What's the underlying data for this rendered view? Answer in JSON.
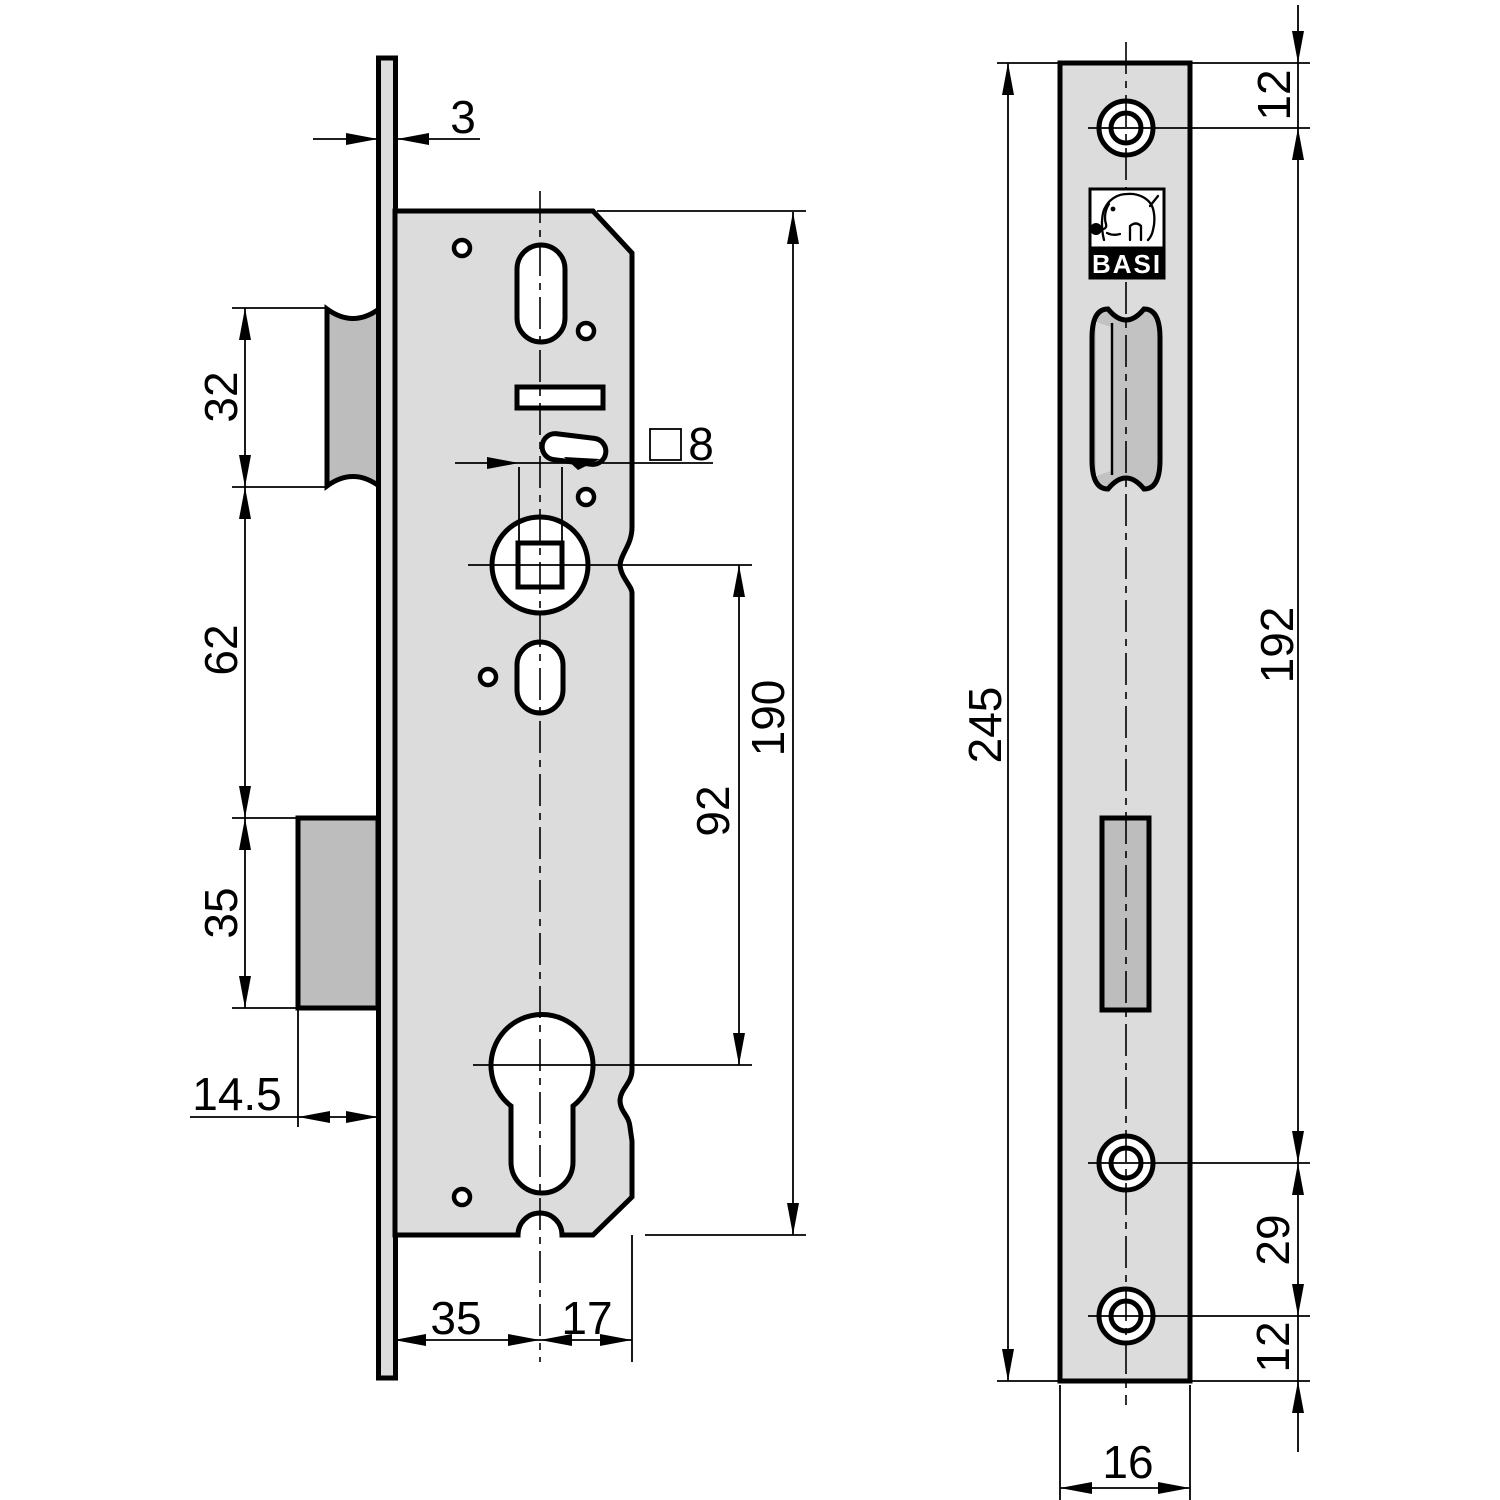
{
  "left_view": {
    "plate_thickness": "3",
    "latch_height": "32",
    "latch_to_bolt_gap": "62",
    "bolt_height": "35",
    "bolt_throw": "14.5",
    "backset": "35",
    "axis_to_case_back": "17",
    "spindle_to_cylinder": "92",
    "case_height": "190",
    "spindle_square_size": "8"
  },
  "right_view": {
    "brand": "BASI",
    "logo_icon": "elephant-with-key",
    "plate_height": "245",
    "screw_spacing": "192",
    "top_screw_offset": "12",
    "lower_screw_spacing": "29",
    "bottom_screw_offset": "12",
    "plate_width": "16"
  }
}
